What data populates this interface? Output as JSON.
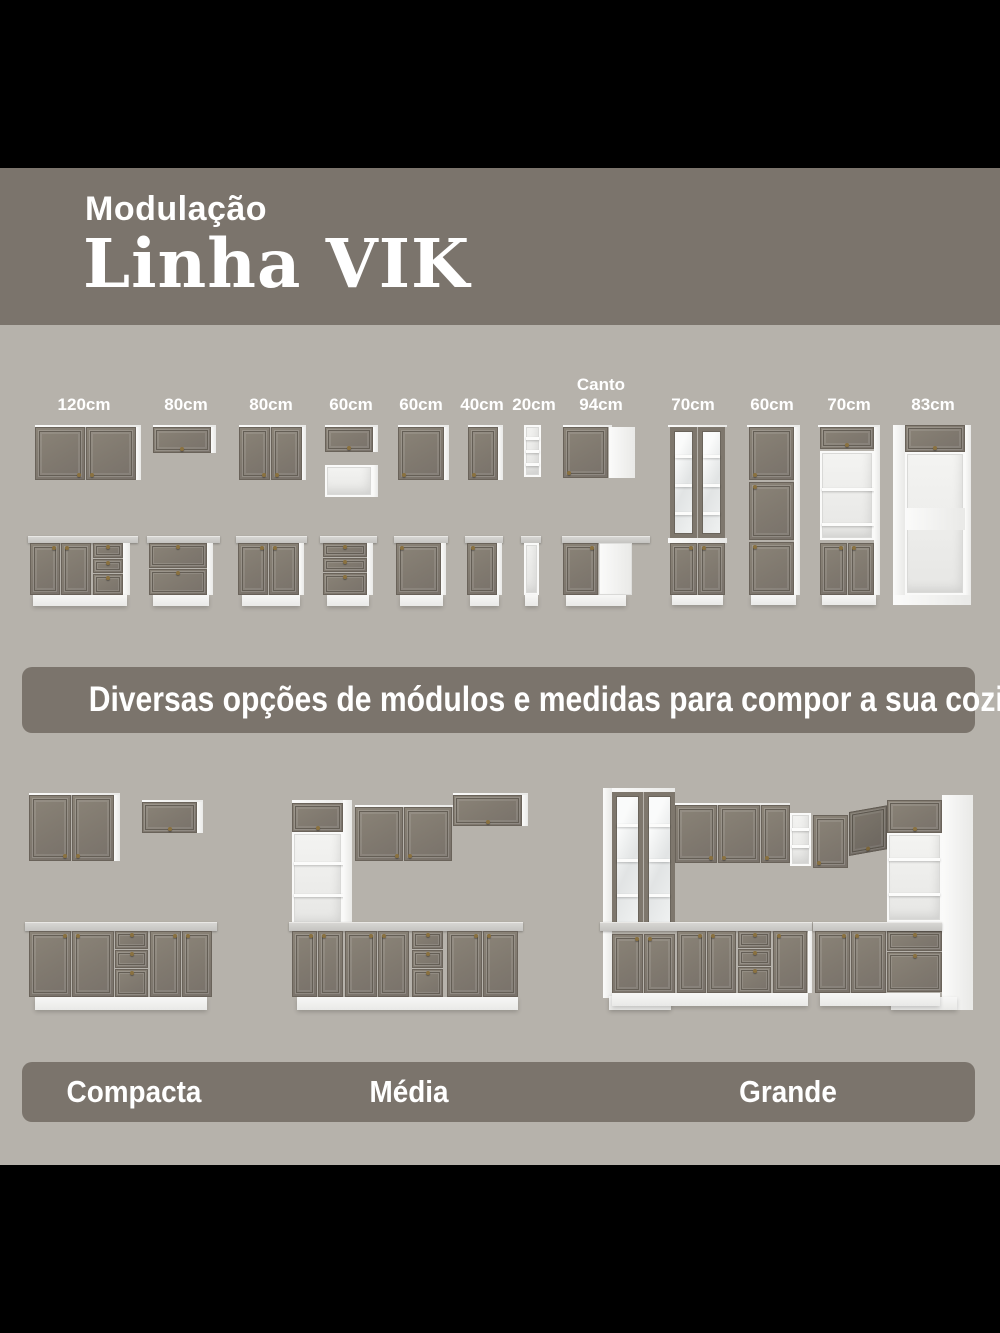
{
  "header": {
    "kicker": "Modulação",
    "title": "Linha VIK"
  },
  "modules": {
    "labels": [
      {
        "t": "120cm"
      },
      {
        "t": "80cm"
      },
      {
        "t": "80cm"
      },
      {
        "t": "60cm"
      },
      {
        "t": "60cm"
      },
      {
        "t": "40cm"
      },
      {
        "t": "20cm"
      },
      {
        "pre": "Canto",
        "t": "94cm"
      },
      {
        "t": "70cm"
      },
      {
        "t": "60cm"
      },
      {
        "t": "70cm"
      },
      {
        "t": "83cm"
      }
    ]
  },
  "banner": {
    "text": "Diversas opções de módulos e medidas para compor a sua cozinha!"
  },
  "kitchens": {
    "labels": [
      "Compacta",
      "Média",
      "Grande"
    ]
  },
  "colors": {
    "letterbox": "#000000",
    "band": "#7b746c",
    "background": "#b6b2ab",
    "door": "#80796f",
    "carcass": "#f5f5f4",
    "countertop": "#cbcac7",
    "text": "#ffffff"
  }
}
